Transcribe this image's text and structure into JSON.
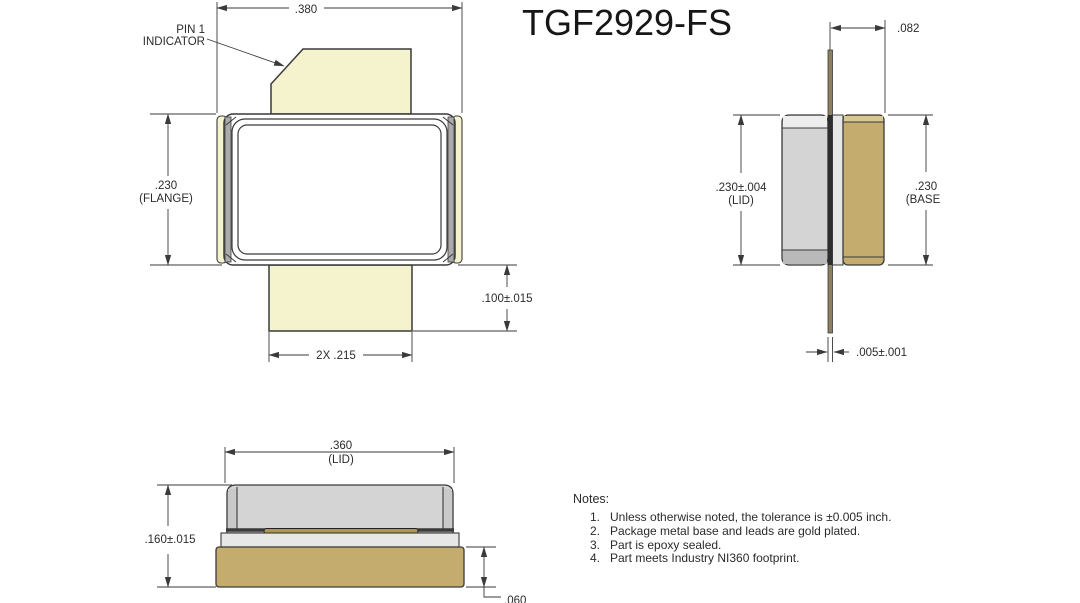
{
  "title": "TGF2929-FS",
  "colors": {
    "line": "#3a3a3a",
    "lead_pale": "#F5F3CD",
    "base_tan": "#C3AC6D",
    "base_light": "#D8C891",
    "base_dark": "#A8924E",
    "lid_gray": "#D4D4D4",
    "lid_light": "#EDEDED",
    "lid_dark": "#B9B9B9",
    "lid_side": "#C9C9C9",
    "ceramic": "#E7E7E7",
    "edge_gray": "#ABABAB",
    "lead_olive": "#8B8161",
    "lead_dark": "#2e2e2e",
    "lead_gold": "#AD9752"
  },
  "top_view": {
    "pin1_line1": "PIN 1",
    "pin1_line2": "INDICATOR",
    "dim_overall_width": ".380",
    "dim_flange": ".230",
    "dim_flange_label": "(FLANGE)",
    "dim_lead_length": ".100±.015",
    "dim_lead_width": "2X .215"
  },
  "side_view": {
    "dim_lead_offset": ".082",
    "dim_lid": ".230±.004",
    "dim_lid_label": "(LID)",
    "dim_base": ".230",
    "dim_base_label": "(BASE",
    "dim_lead_thickness": ".005±.001"
  },
  "front_view": {
    "dim_lid_width": ".360",
    "dim_lid_width_label": "(LID)",
    "dim_overall_height": ".160±.015",
    "dim_base_height": ".060"
  },
  "notes": {
    "heading": "Notes:",
    "items": [
      {
        "num": "1.",
        "text": "Unless otherwise noted, the tolerance is ±0.005 inch."
      },
      {
        "num": "2.",
        "text": "Package metal base and leads are gold plated."
      },
      {
        "num": "3.",
        "text": "Part is epoxy sealed."
      },
      {
        "num": "4.",
        "text": "Part meets Industry NI360 footprint."
      }
    ]
  }
}
